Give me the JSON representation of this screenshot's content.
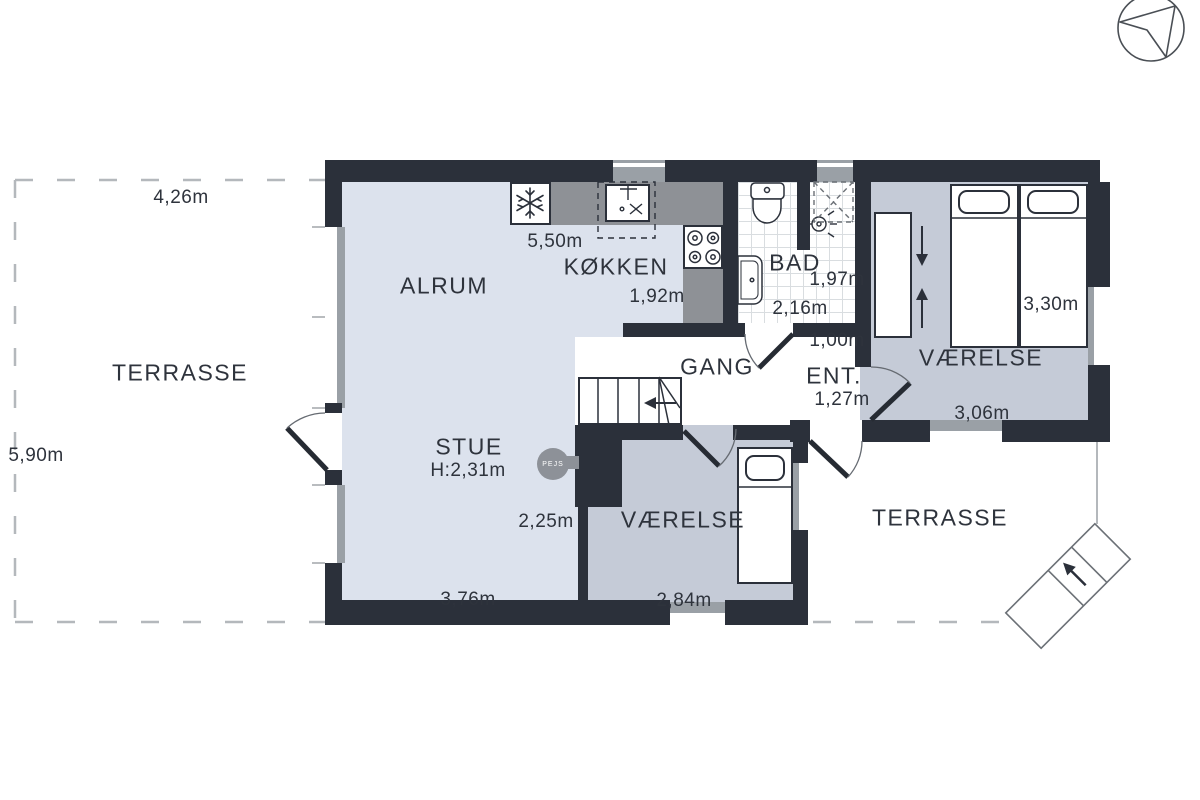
{
  "title": "Sommerhus plantegning / stueplan",
  "labels": {
    "terrasse_left": "TERRASSE",
    "terrasse_right": "TERRASSE",
    "alrum": "ALRUM",
    "kokken": "KØKKEN",
    "bad": "BAD",
    "gang": "GANG",
    "ent": "ENT.",
    "vaerelse_top": "VÆRELSE",
    "vaerelse_bottom": "VÆRELSE",
    "stue": "STUE",
    "stue_height": "H:2,31m",
    "pejs": "PEJS"
  },
  "measurements": {
    "terrasse_left_width": "4,26m",
    "terrasse_left_depth": "5,90m",
    "kokken_width": "5,50m",
    "kokken_depth": "1,92m",
    "bad_width": "1,97m",
    "bad_depth": "2,16m",
    "ent_wall": "1,00m",
    "ent_width": "1,27m",
    "vaerelse_top_width": "3,30m",
    "vaerelse_top_depth": "3,06m",
    "stue_depth": "2,25m",
    "stue_width": "3,76m",
    "vaerelse_bottom_width": "2,84m"
  },
  "icons": {
    "compass": "north-arrow-compass-icon",
    "refrigerator": "snowflake-icon",
    "kitchen_sink": "sink-faucet-icon",
    "stove": "four-burner-stove-icon",
    "toilet": "toilet-icon",
    "bath_sink": "washbasin-icon",
    "shower": "shower-head-icon",
    "fireplace": "round-stove-icon",
    "stairs_arrow": "direction-arrow-icon",
    "exterior_steps": "garden-steps-icon"
  },
  "colors": {
    "wall": "#2b303a",
    "floor_living": "#dce2ed",
    "floor_bedroom": "#c5cbd7",
    "kitchen_counter": "#8e9196",
    "window_frame": "#9aa0a6",
    "tile_line": "#d9dde0",
    "dashed_boundary": "#b4b8bc",
    "text": "#2e333c",
    "fireplace": "#8d9198"
  }
}
